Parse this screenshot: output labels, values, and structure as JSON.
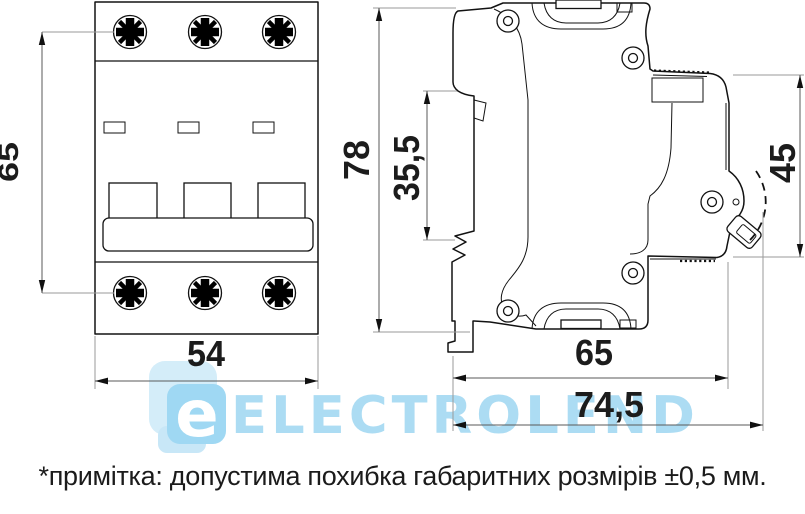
{
  "drawing": {
    "title": "circuit-breaker-dimension-drawing",
    "front_view": {
      "dim_mounting_pitch": "65",
      "dim_width": "54"
    },
    "side_view": {
      "dim_height": "78",
      "dim_din_window": "35,5",
      "dim_front_depth": "45",
      "dim_body_depth": "65",
      "dim_total_depth": "74,5"
    }
  },
  "watermark": {
    "letter": "e",
    "text": "ELECTROLEND",
    "accent_color": "#9ed7f2"
  },
  "footnote": {
    "text": "*примітка: допустима похибка габаритних розмірів ±0,5 мм."
  }
}
